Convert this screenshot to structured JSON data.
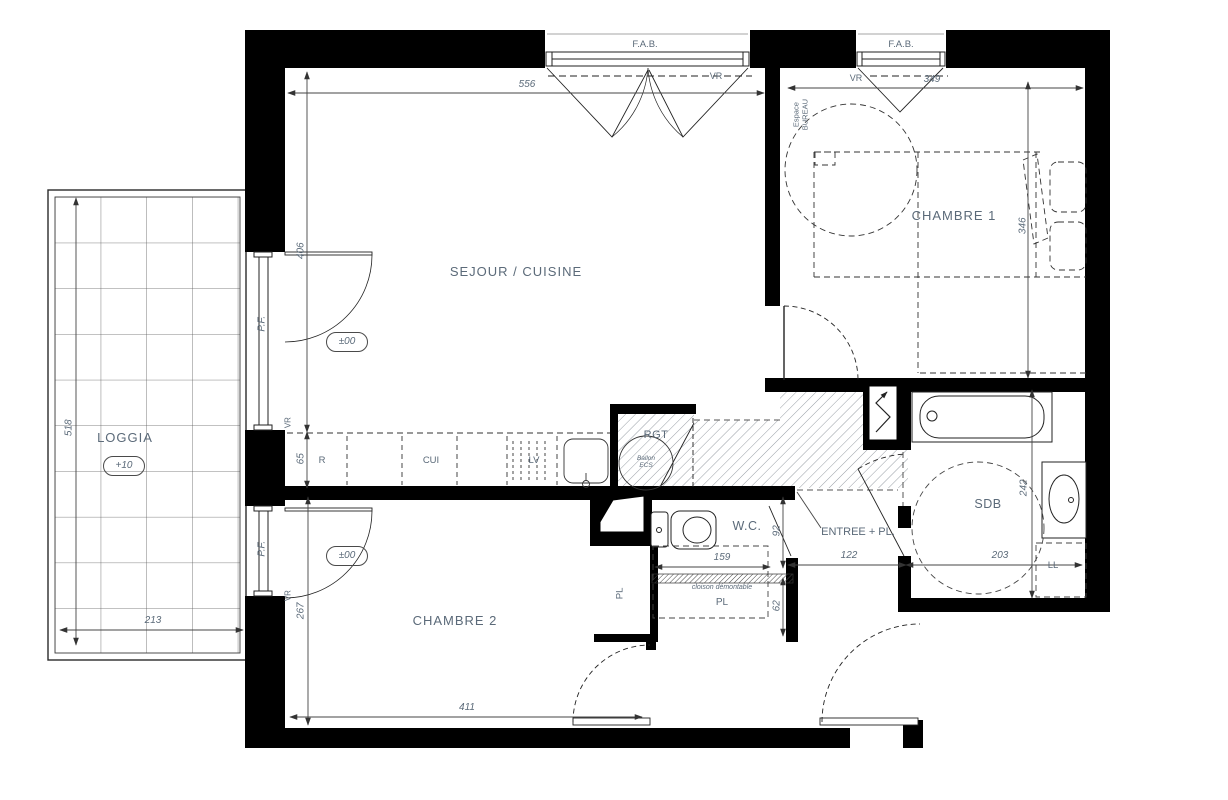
{
  "rooms": {
    "loggia": "LOGGIA",
    "sejour_cuisine": "SEJOUR / CUISINE",
    "chambre1": "CHAMBRE 1",
    "chambre2": "CHAMBRE 2",
    "wc": "W.C.",
    "sdb": "SDB",
    "entree": "ENTREE + PL.",
    "rgt": "RGT",
    "espace_bureau": "Espace\nBUREAU"
  },
  "levels": {
    "loggia": "+10",
    "sejour": "±00",
    "chambre2": "±00"
  },
  "openings": {
    "fab": "F.A.B.",
    "pf": "P.F.",
    "vr": "VR"
  },
  "equipment": {
    "fridge": "R",
    "cooktop": "CUI",
    "dishwasher": "LV",
    "washing_machine": "LL",
    "closet": "PL",
    "water_heater": "Ballon\nECS",
    "partition_note": "cloison démontable"
  },
  "dimensions_cm": {
    "sejour_width": "556",
    "chambre1_width": "349",
    "sejour_depth": "406",
    "counter_depth": "65",
    "chambre1_depth": "346",
    "loggia_depth": "518",
    "loggia_width": "213",
    "chambre2_depth": "267",
    "chambre2_width": "411",
    "wc_depth": "92",
    "wc_width": "159",
    "pl_depth": "62",
    "entree_width": "122",
    "sdb_width": "203",
    "sdb_depth": "242"
  },
  "colors": {
    "wall": "#000000",
    "line": "#3c3c3c",
    "annotation": "#5b6a79"
  }
}
